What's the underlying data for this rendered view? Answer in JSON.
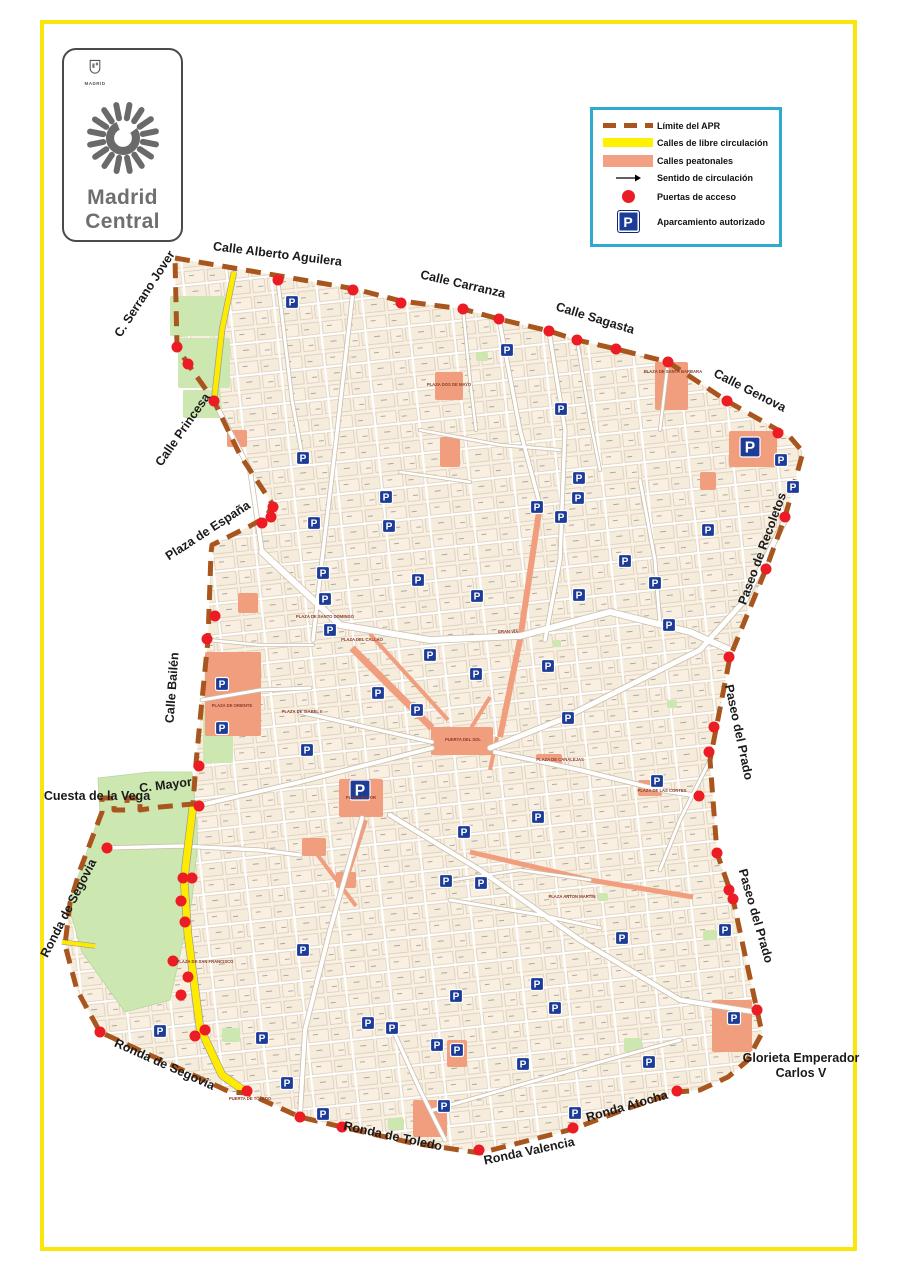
{
  "logo": {
    "city_label": "MADRID",
    "title_line1": "Madrid",
    "title_line2": "Central"
  },
  "legend": {
    "border_color": "#2FA9CE",
    "items": [
      {
        "id": "apr-limit",
        "label": "Límite del APR",
        "color": "#A9561E"
      },
      {
        "id": "free-circulation",
        "label": "Calles de libre circulación",
        "color": "#FFF100"
      },
      {
        "id": "pedestrian",
        "label": "Calles peatonales",
        "color": "#F2A185"
      },
      {
        "id": "direction",
        "label": "Sentido de circulación",
        "color": "#000000"
      },
      {
        "id": "access-gates",
        "label": "Puertas de acceso",
        "color": "#EC1C24"
      },
      {
        "id": "authorized-parking",
        "label": "Aparcamiento autorizado",
        "color": "#1C3C97"
      }
    ]
  },
  "map": {
    "colors": {
      "zone_bg": "#FAF0E2",
      "block_line": "#D9CDBA",
      "boundary": "#A9561E",
      "gate": "#EC1C24",
      "parking": "#1C3C97",
      "pedestrian": "#F09E7E",
      "park": "#CDE7B0",
      "road_yellow": "#FFEB00",
      "street_casing": "#C9BEAC",
      "street_fill": "#FFFFFF"
    },
    "boundary": "175,258 280,276 355,289 401,301 463,309 499,319 549,331 577,340 616,349 668,362 727,401 790,437 803,452 785,517 766,569 730,657 710,760 717,853 733,899 745,955 757,1010 762,1033 747,1061 728,1077 700,1090 677,1092 623,1110 573,1129 480,1153 412,1143 342,1127 300,1117 247,1093 230,1092 165,1062 100,1032 77,990 65,945 70,903 80,870 102,812 102,798 114,798 114,810 127,810 127,798 140,798 140,810 160,807 193,804 196,763 202,700 208,640 211,553 212,545 250,526 266,517 273,505 240,455 214,401 188,364 177,347",
    "parks": [
      [
        170,
        296,
        55,
        40
      ],
      [
        178,
        338,
        52,
        50
      ],
      [
        183,
        390,
        38,
        28
      ],
      [
        203,
        705,
        30,
        58
      ],
      [
        222,
        1028,
        18,
        14
      ],
      [
        388,
        1118,
        16,
        12
      ],
      [
        624,
        1038,
        18,
        14
      ],
      [
        667,
        700,
        10,
        8
      ],
      [
        553,
        640,
        8,
        7
      ],
      [
        598,
        893,
        10,
        8
      ],
      [
        476,
        352,
        12,
        9
      ],
      [
        703,
        930,
        14,
        10
      ]
    ],
    "park_poly": "98,778 150,772 192,772 198,840 192,900 170,1000 125,1012 82,952 68,905 84,860 100,814",
    "ped_rects": [
      [
        227,
        430,
        20,
        17
      ],
      [
        238,
        593,
        20,
        20
      ],
      [
        205,
        652,
        56,
        84
      ],
      [
        339,
        779,
        44,
        38
      ],
      [
        431,
        727,
        62,
        28
      ],
      [
        655,
        362,
        33,
        48
      ],
      [
        729,
        431,
        48,
        36
      ],
      [
        435,
        372,
        28,
        28
      ],
      [
        440,
        437,
        20,
        30
      ],
      [
        712,
        1000,
        40,
        52
      ],
      [
        447,
        1040,
        20,
        27
      ],
      [
        413,
        1100,
        34,
        37
      ],
      [
        302,
        838,
        24,
        18
      ],
      [
        336,
        872,
        20,
        16
      ],
      [
        638,
        780,
        24,
        16
      ],
      [
        536,
        754,
        26,
        10
      ],
      [
        700,
        472,
        16,
        18
      ]
    ],
    "ped_lines": [
      {
        "p": "352,648 432,728",
        "w": 7
      },
      {
        "p": "370,634 448,720",
        "w": 4
      },
      {
        "p": "540,505 520,640 500,737",
        "w": 6
      },
      {
        "p": "470,852 590,880 693,897",
        "w": 5
      },
      {
        "p": "365,820 346,878",
        "w": 6
      },
      {
        "p": "310,845 356,906",
        "w": 4
      },
      {
        "p": "468,733 490,697",
        "w": 4
      },
      {
        "p": "497,737 490,770",
        "w": 4
      }
    ],
    "yellow_lines": [
      {
        "p": "234,272 222,330 214,401",
        "w": 5
      },
      {
        "p": "193,806 184,880 188,935 200,1028 222,1075 246,1092",
        "w": 7
      },
      {
        "p": "62,942 95,946",
        "w": 4
      }
    ],
    "streets": [
      {
        "p": "262,552 340,625 430,640 520,636 610,612 690,632 730,650",
        "w": 6
      },
      {
        "p": "490,748 560,720 640,680 700,650 745,600 785,520",
        "w": 5
      },
      {
        "p": "196,806 300,782 432,748",
        "w": 4
      },
      {
        "p": "300,712 370,728 432,742",
        "w": 3.5
      },
      {
        "p": "495,752 580,770 660,790 699,796",
        "w": 4
      },
      {
        "p": "390,815 480,870 580,940 680,1000 755,1012",
        "w": 4.5
      },
      {
        "p": "362,818 330,930 305,1030 300,1115",
        "w": 4
      },
      {
        "p": "107,848 180,846 260,850 300,855",
        "w": 3.5
      },
      {
        "p": "353,291 335,450 322,560 313,640",
        "w": 3.5
      },
      {
        "p": "499,319 520,430 540,505",
        "w": 3.5
      },
      {
        "p": "549,331 565,430 560,560 545,640",
        "w": 3.5
      },
      {
        "p": "278,282 292,400 303,460",
        "w": 3
      },
      {
        "p": "214,401 250,470 262,552",
        "w": 4
      },
      {
        "p": "640,480 655,560 660,625",
        "w": 3
      },
      {
        "p": "392,1028 420,1090 445,1140",
        "w": 3.5
      },
      {
        "p": "450,900 540,915 600,928",
        "w": 3
      },
      {
        "p": "420,430 500,445 560,450",
        "w": 2.5
      },
      {
        "p": "400,472 470,482",
        "w": 2.5
      },
      {
        "p": "433,1110 520,1085 600,1062 680,1040",
        "w": 3
      },
      {
        "p": "446,881 520,870 590,880",
        "w": 2.5
      },
      {
        "p": "710,760 680,820 660,870",
        "w": 3
      },
      {
        "p": "577,340 590,420 600,470",
        "w": 2.5
      },
      {
        "p": "668,362 660,430",
        "w": 2.5
      },
      {
        "p": "463,309 470,380 476,430",
        "w": 2.5
      },
      {
        "p": "202,700 260,690 310,688",
        "w": 3
      },
      {
        "p": "208,640 260,645 313,645",
        "w": 2.5
      }
    ],
    "gates": [
      [
        278,
        280
      ],
      [
        353,
        290
      ],
      [
        401,
        303
      ],
      [
        463,
        309
      ],
      [
        499,
        319
      ],
      [
        549,
        331
      ],
      [
        577,
        340
      ],
      [
        616,
        349
      ],
      [
        668,
        362
      ],
      [
        727,
        401
      ],
      [
        778,
        433
      ],
      [
        785,
        517
      ],
      [
        766,
        569
      ],
      [
        729,
        657
      ],
      [
        714,
        727
      ],
      [
        709,
        752
      ],
      [
        699,
        796
      ],
      [
        717,
        853
      ],
      [
        729,
        890
      ],
      [
        733,
        899
      ],
      [
        757,
        1010
      ],
      [
        677,
        1091
      ],
      [
        573,
        1128
      ],
      [
        479,
        1150
      ],
      [
        342,
        1127
      ],
      [
        300,
        1117
      ],
      [
        247,
        1091
      ],
      [
        100,
        1032
      ],
      [
        107,
        848
      ],
      [
        177,
        347
      ],
      [
        188,
        364
      ],
      [
        214,
        401
      ],
      [
        273,
        507
      ],
      [
        271,
        517
      ],
      [
        262,
        523
      ],
      [
        215,
        616
      ],
      [
        207,
        639
      ],
      [
        199,
        766
      ],
      [
        199,
        806
      ],
      [
        183,
        878
      ],
      [
        192,
        878
      ],
      [
        181,
        901
      ],
      [
        185,
        922
      ],
      [
        173,
        961
      ],
      [
        188,
        977
      ],
      [
        181,
        995
      ],
      [
        205,
        1030
      ],
      [
        195,
        1036
      ]
    ],
    "parkings": [
      [
        292,
        302
      ],
      [
        303,
        458
      ],
      [
        314,
        523
      ],
      [
        386,
        497
      ],
      [
        389,
        526
      ],
      [
        323,
        573
      ],
      [
        325,
        599
      ],
      [
        418,
        580
      ],
      [
        330,
        630
      ],
      [
        430,
        655
      ],
      [
        378,
        693
      ],
      [
        417,
        710
      ],
      [
        222,
        684
      ],
      [
        477,
        596
      ],
      [
        507,
        350
      ],
      [
        561,
        409
      ],
      [
        750,
        447,
        20
      ],
      [
        781,
        460
      ],
      [
        793,
        487
      ],
      [
        579,
        478
      ],
      [
        578,
        498
      ],
      [
        537,
        507
      ],
      [
        561,
        517
      ],
      [
        708,
        530
      ],
      [
        625,
        561
      ],
      [
        655,
        583
      ],
      [
        579,
        595
      ],
      [
        669,
        625
      ],
      [
        548,
        666
      ],
      [
        476,
        674
      ],
      [
        222,
        728
      ],
      [
        307,
        750
      ],
      [
        360,
        790,
        20
      ],
      [
        446,
        881
      ],
      [
        303,
        950
      ],
      [
        456,
        996
      ],
      [
        368,
        1023
      ],
      [
        392,
        1028
      ],
      [
        160,
        1031
      ],
      [
        437,
        1045
      ],
      [
        457,
        1050
      ],
      [
        262,
        1038
      ],
      [
        287,
        1083
      ],
      [
        323,
        1114
      ],
      [
        444,
        1106
      ],
      [
        568,
        718
      ],
      [
        657,
        781
      ],
      [
        538,
        817
      ],
      [
        464,
        832
      ],
      [
        481,
        883
      ],
      [
        725,
        930
      ],
      [
        622,
        938
      ],
      [
        537,
        984
      ],
      [
        555,
        1008
      ],
      [
        523,
        1064
      ],
      [
        734,
        1018
      ],
      [
        649,
        1062
      ],
      [
        575,
        1113
      ]
    ],
    "street_labels": [
      {
        "t": "C. Serrano Jover",
        "x": 148,
        "y": 296,
        "r": -57
      },
      {
        "t": "Calle Alberto Aguilera",
        "x": 277,
        "y": 258,
        "r": 7
      },
      {
        "t": "Calle Carranza",
        "x": 462,
        "y": 288,
        "r": 13
      },
      {
        "t": "Calle Sagasta",
        "x": 594,
        "y": 322,
        "r": 17
      },
      {
        "t": "Calle Genova",
        "x": 748,
        "y": 394,
        "r": 27
      },
      {
        "t": "Paseo de Recoletos",
        "x": 766,
        "y": 550,
        "r": -70
      },
      {
        "t": "Paseo del Prado",
        "x": 735,
        "y": 733,
        "r": 78
      },
      {
        "t": "Paseo del Prado",
        "x": 752,
        "y": 917,
        "r": 74
      },
      {
        "t": "Glorieta Emperador",
        "x": 801,
        "y": 1062,
        "r": 0
      },
      {
        "t": "Carlos V",
        "x": 801,
        "y": 1077,
        "r": 0
      },
      {
        "t": "Ronda Atocha",
        "x": 628,
        "y": 1110,
        "r": -16
      },
      {
        "t": "Ronda Valencia",
        "x": 530,
        "y": 1155,
        "r": -12
      },
      {
        "t": "Ronda de Toledo",
        "x": 392,
        "y": 1140,
        "r": 12
      },
      {
        "t": "Ronda de Segovia",
        "x": 163,
        "y": 1068,
        "r": 24
      },
      {
        "t": "Ronda de Segovia",
        "x": 72,
        "y": 910,
        "r": -63
      },
      {
        "t": "Cuesta de la Vega",
        "x": 97,
        "y": 800,
        "r": 0
      },
      {
        "t": "C. Mayor",
        "x": 166,
        "y": 789,
        "r": -7
      },
      {
        "t": "Calle Bailén",
        "x": 176,
        "y": 688,
        "r": -86
      },
      {
        "t": "Calle Princesa",
        "x": 186,
        "y": 432,
        "r": -55
      },
      {
        "t": "Plaza de España",
        "x": 210,
        "y": 534,
        "r": -33
      }
    ],
    "place_labels": [
      {
        "t": "PUERTA DEL SOL",
        "x": 463,
        "y": 741
      },
      {
        "t": "PLAZA MAYOR",
        "x": 361,
        "y": 799
      },
      {
        "t": "PLAZA DE ORIENTE",
        "x": 232,
        "y": 707
      },
      {
        "t": "PLAZA DE ISABEL II",
        "x": 302,
        "y": 713
      },
      {
        "t": "PLAZA DE SANTO DOMINGO",
        "x": 325,
        "y": 618
      },
      {
        "t": "PLAZA DEL CALLAO",
        "x": 362,
        "y": 641
      },
      {
        "t": "PLAZA DE SANTA BARBARA",
        "x": 673,
        "y": 373
      },
      {
        "t": "PLAZA DOS DE MAYO",
        "x": 449,
        "y": 386
      },
      {
        "t": "PLAZA DE LAS CORTES",
        "x": 662,
        "y": 792
      },
      {
        "t": "PLAZA DE CANALEJAS",
        "x": 560,
        "y": 761
      },
      {
        "t": "PUERTA DE TOLEDO",
        "x": 250,
        "y": 1100
      },
      {
        "t": "PLAZA DE SAN FRANCISCO",
        "x": 205,
        "y": 963
      },
      {
        "t": "PLAZA ANTON MARTIN",
        "x": 572,
        "y": 898
      },
      {
        "t": "GRAN VIA",
        "x": 508,
        "y": 633
      }
    ]
  }
}
